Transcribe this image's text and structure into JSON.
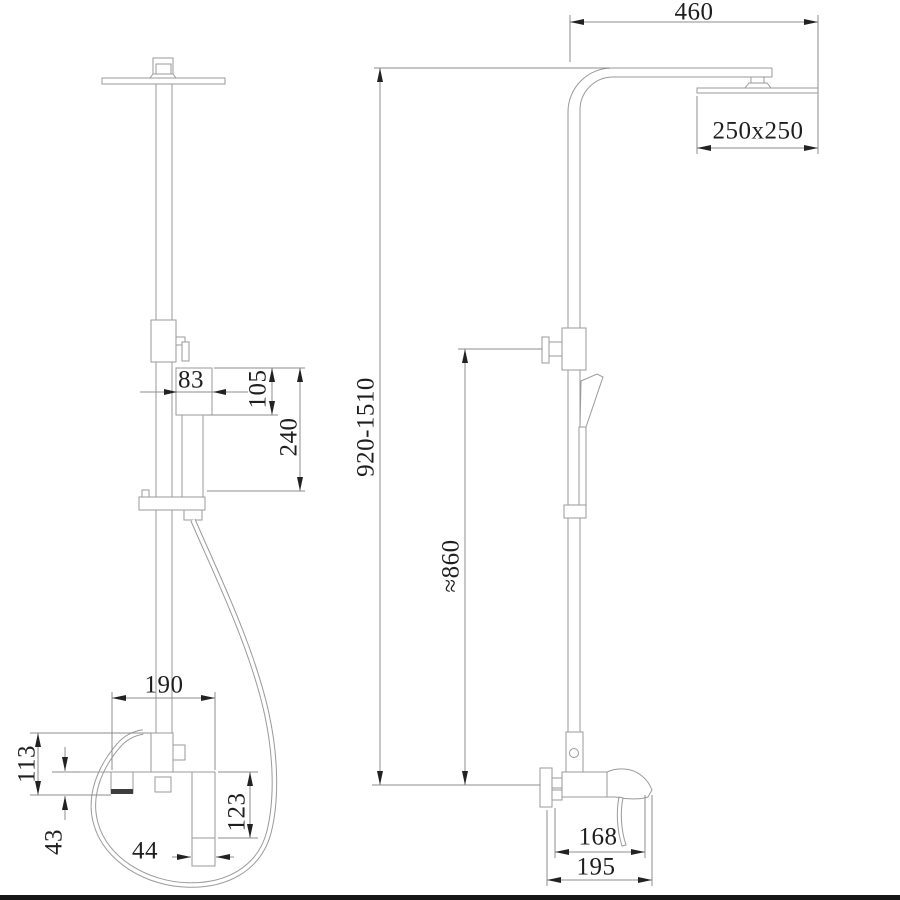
{
  "dimensions": {
    "arm_reach": "460",
    "overhead_shower_size": "250x250",
    "overall_height_range": "920-1510",
    "riser_height": "≈860",
    "handshower_width": "83",
    "handshower_head_height": "105",
    "handshower_length": "240",
    "mixer_width": "190",
    "mixer_body_height": "113",
    "spout_drop_height": "43",
    "handle_width": "44",
    "handle_drop": "123",
    "spout_reach": "168",
    "mixer_depth": "195"
  },
  "drawing": {
    "colors": {
      "background": "#ffffff",
      "object_line": "#9a9a9a",
      "dimension_line": "#8c8c8c",
      "arrow_and_text": "#222222",
      "footer_bar": "#161616"
    }
  }
}
